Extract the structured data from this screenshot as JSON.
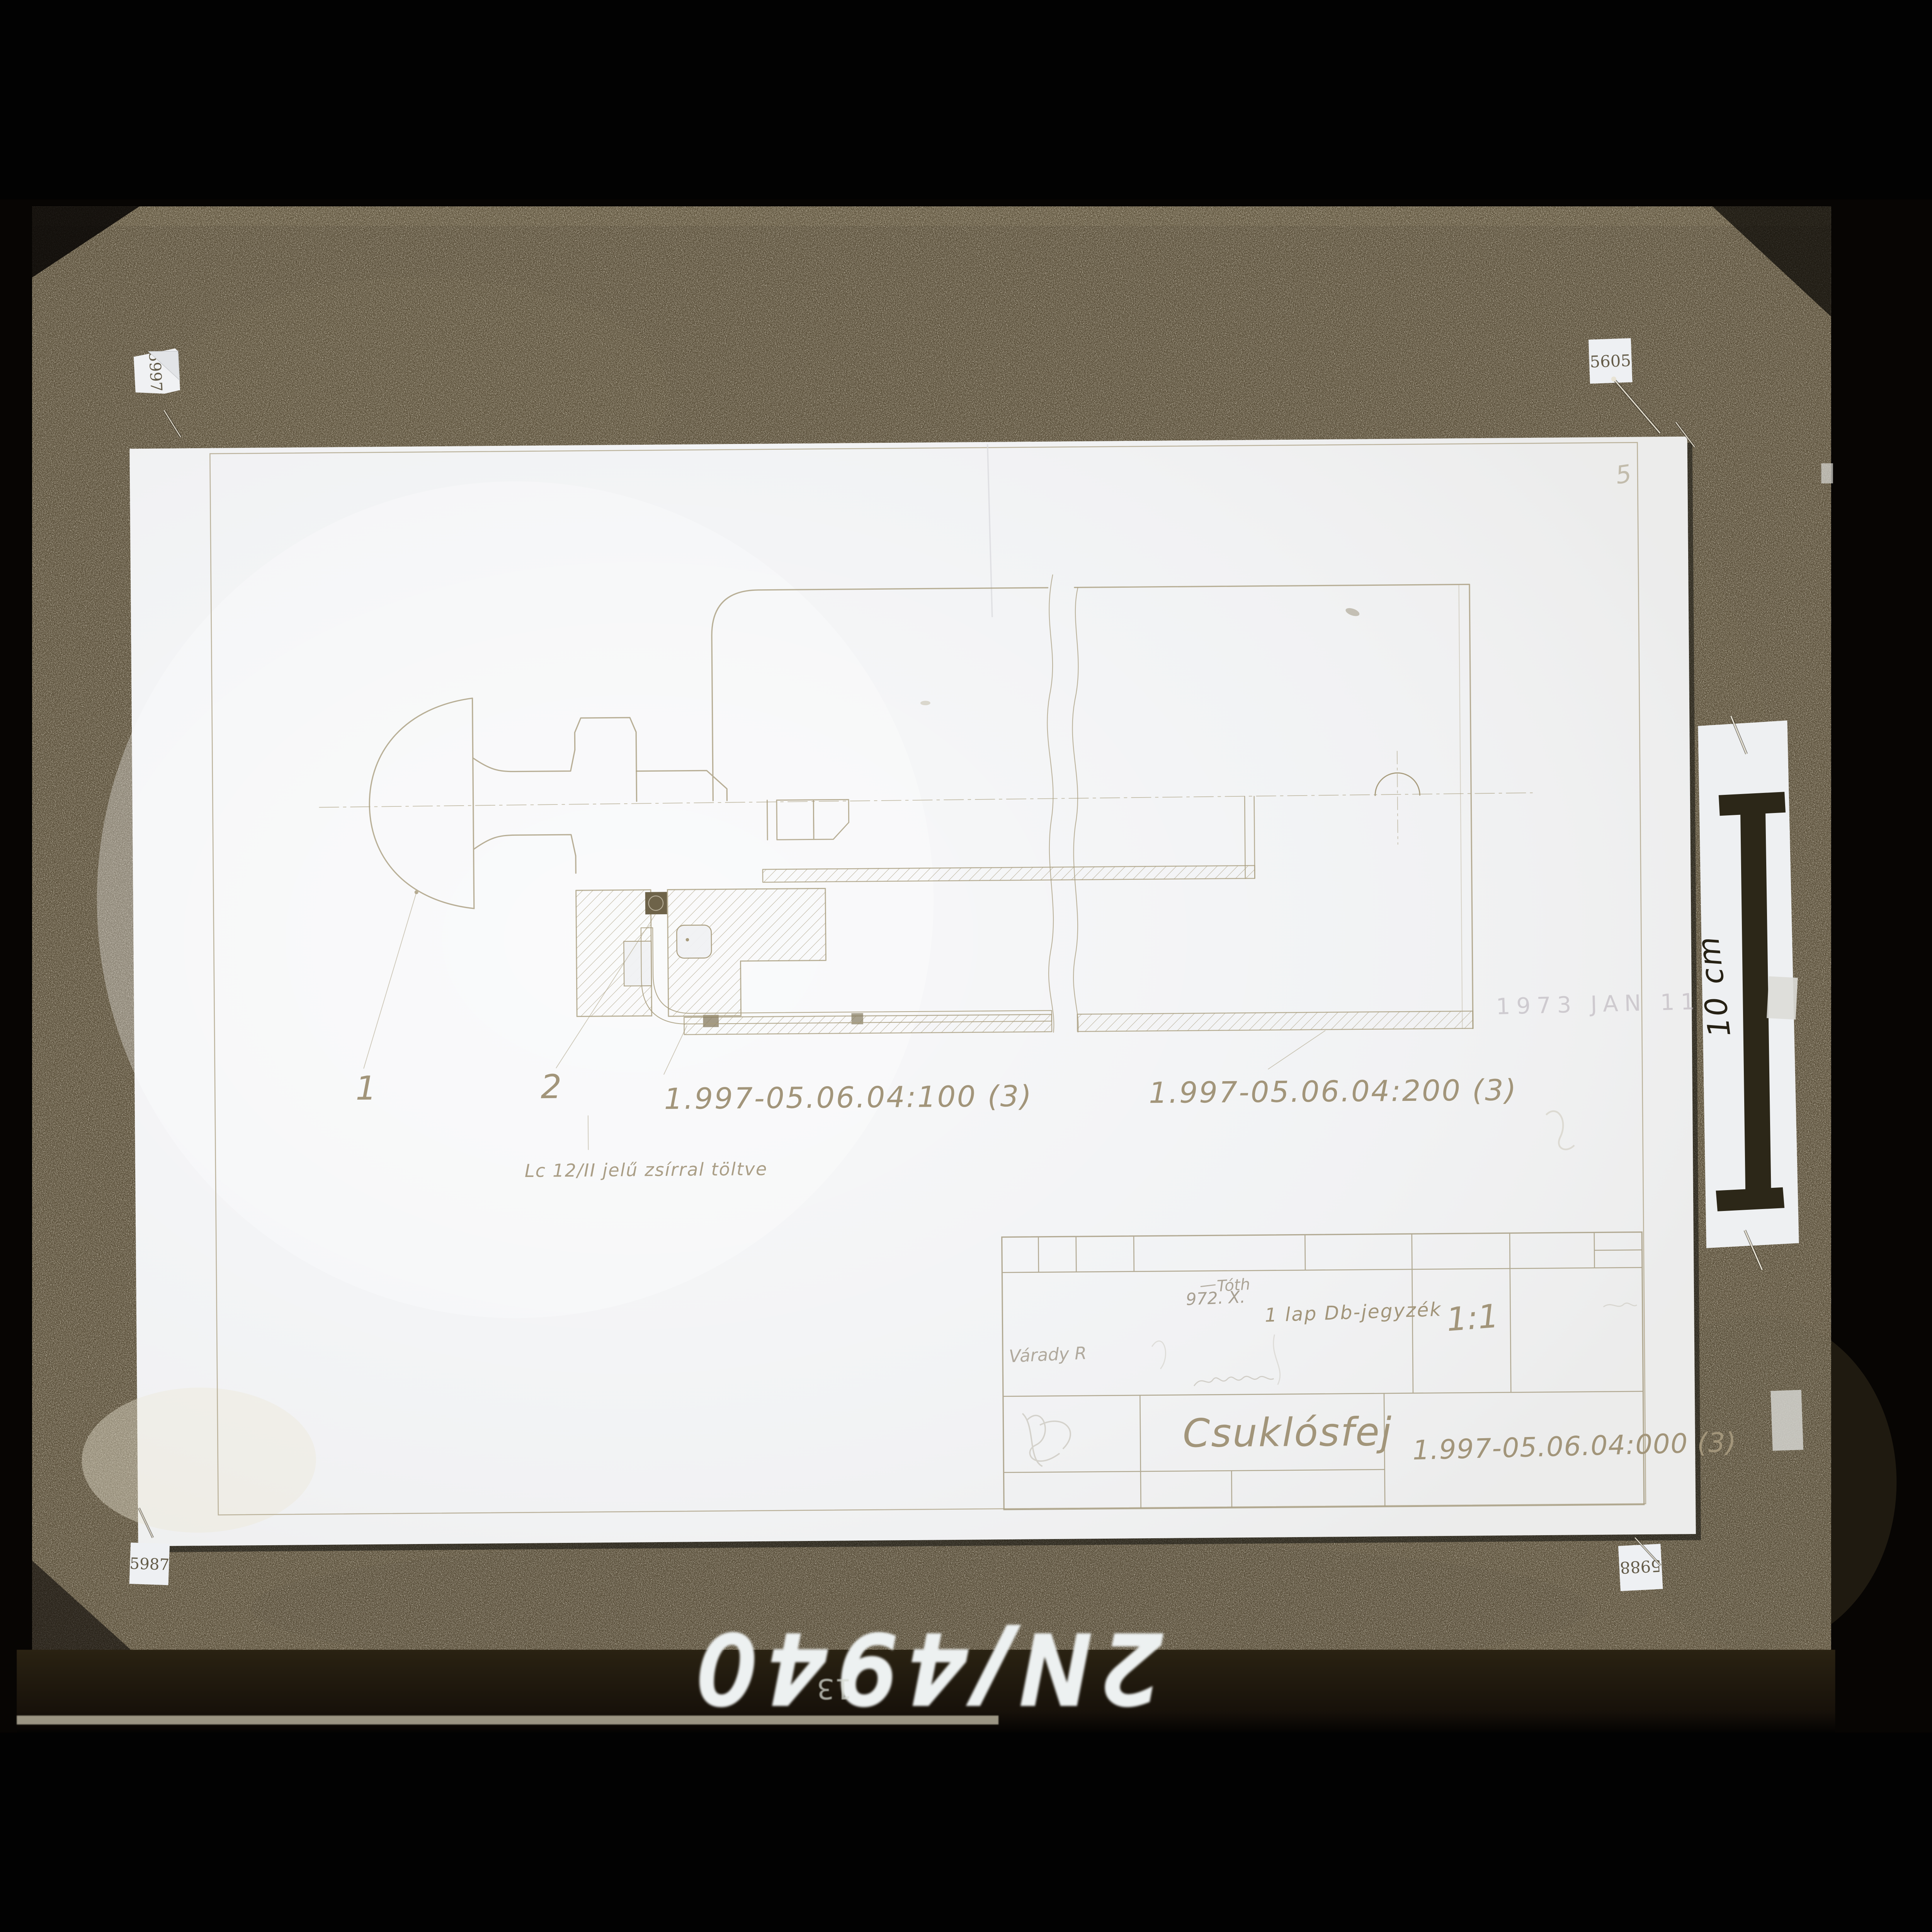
{
  "photo": {
    "archive_tags": {
      "top_left": "5997",
      "top_right": "5605",
      "bottom_left": "5987",
      "bottom_right": "5988"
    },
    "scale_bar": {
      "label": "10 cm"
    },
    "bottom_inscription": {
      "number": "2N/4940",
      "small_number": "13"
    }
  },
  "drawing": {
    "sheet_number": "5",
    "callouts": {
      "item1": "1",
      "item2": "2",
      "part_100": "1.997-05.06.04:100 (3)",
      "part_200": "1.997-05.06.04:200 (3)"
    },
    "note": "Lc 12/II jelű zsírral töltve",
    "date_stamp": "1973 JAN 11",
    "title_block": {
      "sheet_info": "1 lap Db-jegyzék",
      "scale": "1:1",
      "title": "Csuklósfej",
      "drawing_number": "1.997-05.06.04:000 (3)",
      "handwritten_date": "972. X.",
      "approved_signature": "Tóth",
      "signature": "Várady R"
    }
  }
}
